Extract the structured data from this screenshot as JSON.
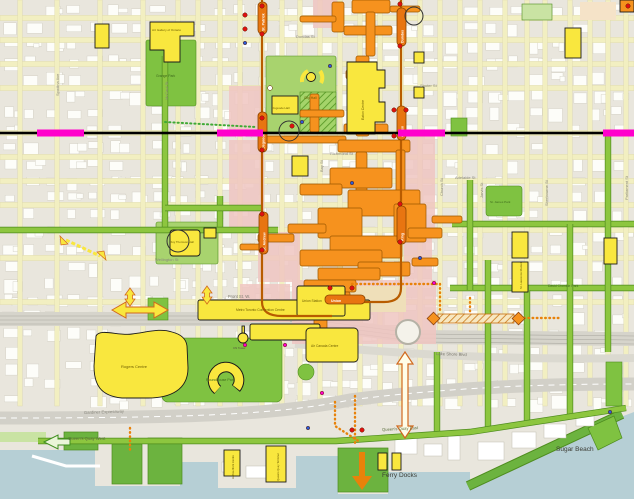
{
  "map": {
    "description_labels": {
      "ferry_docks": "Ferry Docks",
      "sugar_beach": "Sugar Beach"
    }
  },
  "colors": {
    "background": "#e9e6dd",
    "water": "#b6cfd5",
    "street_yellow": "#f2efc1",
    "street_green": "#8dc63f",
    "street_green_edge": "#4e8c1e",
    "park": "#7fc241",
    "park_light": "#a8d36e",
    "pink_zone": "#f0c6c2",
    "tan_zone": "#efdfb9",
    "path_orange": "#f6921e",
    "path_orange_edge": "#9c5700",
    "subway_orange": "#e87511",
    "subway_line": "#b85c00",
    "landmark_yellow": "#f9e73e",
    "magenta": "#ff00cc",
    "queen_line": "#000000",
    "red_dot": "#e01010",
    "blue_dot": "#2b5cd8",
    "road_gray": "#d6d4cb"
  },
  "transit": {
    "queen_line": {
      "y": 133,
      "segments": [
        [
          37,
          84
        ],
        [
          217,
          263
        ],
        [
          398,
          445
        ],
        [
          603,
          634
        ]
      ]
    },
    "stations": [
      {
        "text": "St. Patrick",
        "capsule": [
          258,
          2,
          9,
          32
        ],
        "tx": 264.5,
        "ty": 31,
        "rot": -90
      },
      {
        "text": "Osgoode",
        "capsule": [
          258,
          112,
          9,
          40
        ],
        "tx": 264.5,
        "ty": 149,
        "rot": -90
      },
      {
        "text": "St. Andrew",
        "capsule": [
          259,
          212,
          9,
          42
        ],
        "tx": 265.5,
        "ty": 251,
        "rot": -90
      },
      {
        "text": "Dundas",
        "capsule": [
          397,
          8,
          9,
          38
        ],
        "tx": 403.5,
        "ty": 43,
        "rot": -90
      },
      {
        "text": "Queen",
        "capsule": [
          397,
          106,
          9,
          34
        ],
        "tx": 403.5,
        "ty": 137,
        "rot": -90
      },
      {
        "text": "King",
        "capsule": [
          397,
          206,
          9,
          38
        ],
        "tx": 403.5,
        "ty": 241,
        "rot": -90
      },
      {
        "text": "Union",
        "capsule": [
          325,
          295,
          40,
          9
        ],
        "tx": 331,
        "ty": 302,
        "rot": 0
      }
    ]
  },
  "labels": {
    "streets": [
      {
        "text": "Spadina Ave",
        "x": 59,
        "y": 96,
        "rot": -90,
        "s": 4,
        "c": "#8a887e"
      },
      {
        "text": "McCaul St",
        "x": 168,
        "y": 100,
        "rot": -90,
        "s": 4,
        "c": "#8a887e"
      },
      {
        "text": "Bay St",
        "x": 323,
        "y": 172,
        "rot": -90,
        "s": 4,
        "c": "#8a887e"
      },
      {
        "text": "Church St",
        "x": 443,
        "y": 196,
        "rot": -90,
        "s": 4,
        "c": "#8a887e"
      },
      {
        "text": "Jarvis St",
        "x": 483,
        "y": 198,
        "rot": -90,
        "s": 4,
        "c": "#8a887e"
      },
      {
        "text": "Sherbourne St",
        "x": 548,
        "y": 206,
        "rot": -90,
        "s": 4,
        "c": "#8a887e"
      },
      {
        "text": "Parliament St",
        "x": 628,
        "y": 200,
        "rot": -90,
        "s": 4,
        "c": "#8a887e"
      },
      {
        "text": "Dundas St",
        "x": 296,
        "y": 38,
        "rot": 0,
        "s": 4,
        "c": "#8a887e"
      },
      {
        "text": "Shuter St",
        "x": 420,
        "y": 87,
        "rot": 0,
        "s": 4,
        "c": "#8a887e"
      },
      {
        "text": "Richmond St",
        "x": 330,
        "y": 155,
        "rot": 0,
        "s": 4,
        "c": "#8a887e"
      },
      {
        "text": "Adelaide St",
        "x": 455,
        "y": 179,
        "rot": 0,
        "s": 4,
        "c": "#8a887e"
      },
      {
        "text": "Wellington St",
        "x": 155,
        "y": 261,
        "rot": 0,
        "s": 4,
        "c": "#8a887e"
      },
      {
        "text": "Front St. W.",
        "x": 228,
        "y": 298,
        "rot": 0,
        "s": 4.2,
        "c": "#7b796e"
      },
      {
        "text": "Lake Shore Blvd",
        "x": 436,
        "y": 355,
        "rot": 2,
        "s": 4.2,
        "c": "#7b796e"
      },
      {
        "text": "Gardiner Expressway",
        "x": 84,
        "y": 414,
        "rot": -2,
        "s": 4.2,
        "c": "#8a887e"
      },
      {
        "text": "Queen's Quay West",
        "x": 68,
        "y": 440,
        "rot": 0,
        "s": 4.2,
        "c": "#5e7141"
      },
      {
        "text": "Queen's Quay East",
        "x": 382,
        "y": 431,
        "rot": -3,
        "s": 4.2,
        "c": "#5e7141"
      },
      {
        "text": "David Crombie Park",
        "x": 548,
        "y": 287,
        "rot": 0,
        "s": 3.4,
        "c": "#3f6b1d"
      },
      {
        "text": "Ferry Docks",
        "x": 382,
        "y": 477,
        "rot": 0,
        "s": 6.5,
        "c": "#3c3c34"
      },
      {
        "text": "Sugar Beach",
        "x": 556,
        "y": 451,
        "rot": 0,
        "s": 6.5,
        "c": "#3c3c34"
      }
    ],
    "places": [
      {
        "text": "Art Gallery of Ontario",
        "x": 152,
        "y": 31,
        "rot": 0,
        "s": 3.1,
        "c": "#6d5d00"
      },
      {
        "text": "Grange Park",
        "x": 156,
        "y": 77,
        "rot": 0,
        "s": 3.4,
        "c": "#3f6b1d"
      },
      {
        "text": "City Hall",
        "x": 304,
        "y": 99,
        "rot": 0,
        "s": 3.4,
        "c": "#6d5d00"
      },
      {
        "text": "Osgoode Hall",
        "x": 272,
        "y": 109,
        "rot": 0,
        "s": 2.9,
        "c": "#6d5d00"
      },
      {
        "text": "Eaton Centre",
        "x": 364,
        "y": 120,
        "rot": -90,
        "s": 3.4,
        "c": "#6d5d00"
      },
      {
        "text": "Roy Thomson Hall",
        "x": 170,
        "y": 243,
        "rot": 0,
        "s": 2.9,
        "c": "#6d5d00"
      },
      {
        "text": "Metro Toronto Convention Centre",
        "x": 236,
        "y": 311,
        "rot": 0,
        "s": 3.3,
        "c": "#6d5d00"
      },
      {
        "text": "Rogers Centre",
        "x": 121,
        "y": 368,
        "rot": 0,
        "s": 4,
        "c": "#6d5d00"
      },
      {
        "text": "CN Tower",
        "x": 233,
        "y": 349,
        "rot": 0,
        "s": 2.9,
        "c": "#55523f"
      },
      {
        "text": "Roundhouse Park",
        "x": 206,
        "y": 381,
        "rot": 0,
        "s": 3.6,
        "c": "#3f6b1d"
      },
      {
        "text": "Union Station",
        "x": 302,
        "y": 302,
        "rot": 0,
        "s": 3.3,
        "c": "#6d5d00"
      },
      {
        "text": "Air Canada Centre",
        "x": 311,
        "y": 347,
        "rot": 0,
        "s": 3.3,
        "c": "#6d5d00"
      },
      {
        "text": "St. Lawrence Market",
        "x": 522,
        "y": 289,
        "rot": -90,
        "s": 2.9,
        "c": "#6d5d00"
      },
      {
        "text": "St. James Park",
        "x": 490,
        "y": 203,
        "rot": 0,
        "s": 3,
        "c": "#3f6b1d"
      },
      {
        "text": "Queens Quay Terminal",
        "x": 279,
        "y": 481,
        "rot": -90,
        "s": 2.7,
        "c": "#6d5d00"
      },
      {
        "text": "Harbourfront Centre",
        "x": 234,
        "y": 479,
        "rot": -90,
        "s": 2.7,
        "c": "#6d5d00"
      }
    ]
  },
  "dots": {
    "red": [
      [
        262,
        6
      ],
      [
        262,
        34
      ],
      [
        262,
        118
      ],
      [
        262,
        150
      ],
      [
        262,
        214
      ],
      [
        262,
        250
      ],
      [
        245,
        15
      ],
      [
        245,
        29
      ],
      [
        400,
        4
      ],
      [
        400,
        46
      ],
      [
        394,
        110
      ],
      [
        406,
        110
      ],
      [
        394,
        136
      ],
      [
        400,
        204
      ],
      [
        400,
        242
      ],
      [
        330,
        288
      ],
      [
        352,
        288
      ],
      [
        292,
        126
      ],
      [
        352,
        430
      ],
      [
        362,
        430
      ],
      [
        628,
        6
      ]
    ],
    "blue": [
      [
        245,
        43
      ],
      [
        302,
        122
      ],
      [
        330,
        66
      ],
      [
        352,
        183
      ],
      [
        420,
        258
      ],
      [
        308,
        428
      ],
      [
        610,
        412
      ]
    ],
    "magenta": [
      [
        245,
        345
      ],
      [
        285,
        345
      ],
      [
        434,
        283
      ],
      [
        322,
        393
      ]
    ],
    "white": [
      [
        270,
        88
      ]
    ]
  }
}
